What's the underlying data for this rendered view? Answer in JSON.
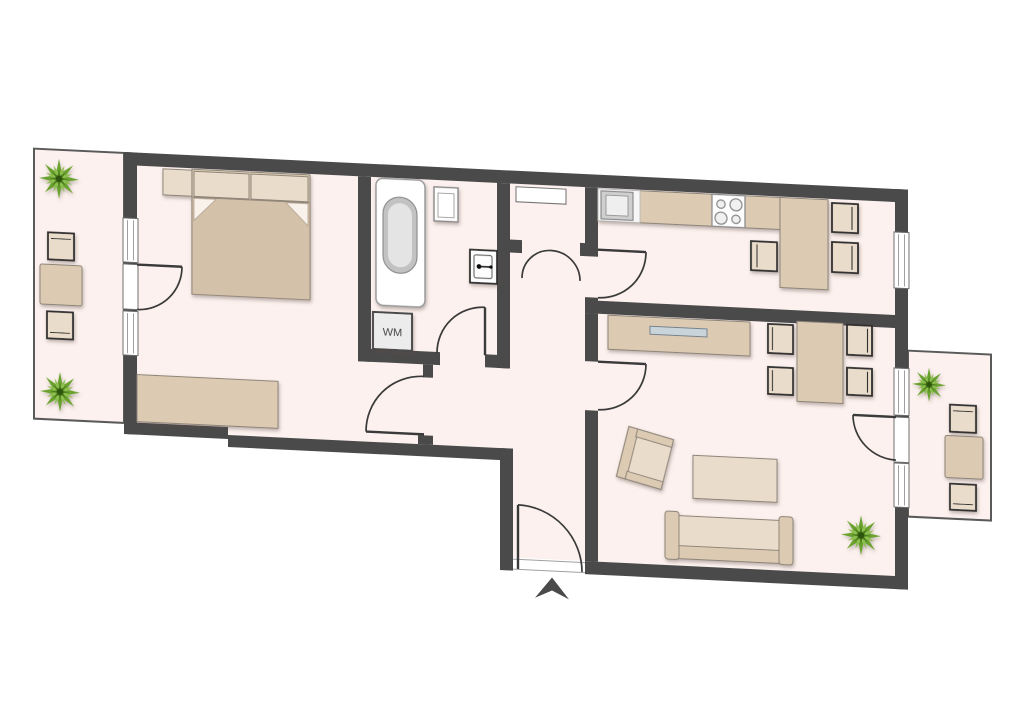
{
  "floorplan": {
    "kind": "apartment-floor-plan",
    "labels": {
      "washing_machine": "WM"
    },
    "colors": {
      "background": "#ffffff",
      "wall": "#4a4a4a",
      "floor": "#fcf1ee",
      "furniture": "#dccab2",
      "furniture_light": "#eadcca",
      "furniture_outline": "#8d8478",
      "chair_outline": "#2e2e2e",
      "door_line": "#3a3a3a",
      "balcony_border": "#5a5a5a",
      "glass_insert": "#c9d3da",
      "fixture_gray": "#c2c2c2",
      "plant_mid": "#6aa22e",
      "plant_light": "#8cbf4e",
      "plant_dark": "#4a7a1a"
    },
    "rooms": [
      "bedroom",
      "bathroom",
      "hallway",
      "closet",
      "kitchen",
      "living-room",
      "left-balcony",
      "right-balcony",
      "entry"
    ],
    "furniture": [
      "double-bed",
      "pillows",
      "nightstand",
      "dresser",
      "bathtub",
      "washbasin",
      "toilet",
      "washing-machine",
      "kitchen-counter",
      "kitchen-sink",
      "stove",
      "kitchen-table",
      "kitchen-chairs",
      "sideboard",
      "dining-table",
      "dining-chairs",
      "armchair",
      "coffee-table",
      "sofa",
      "balcony-table",
      "balcony-chairs",
      "plants"
    ],
    "markers": [
      "entrance-arrow"
    ]
  }
}
